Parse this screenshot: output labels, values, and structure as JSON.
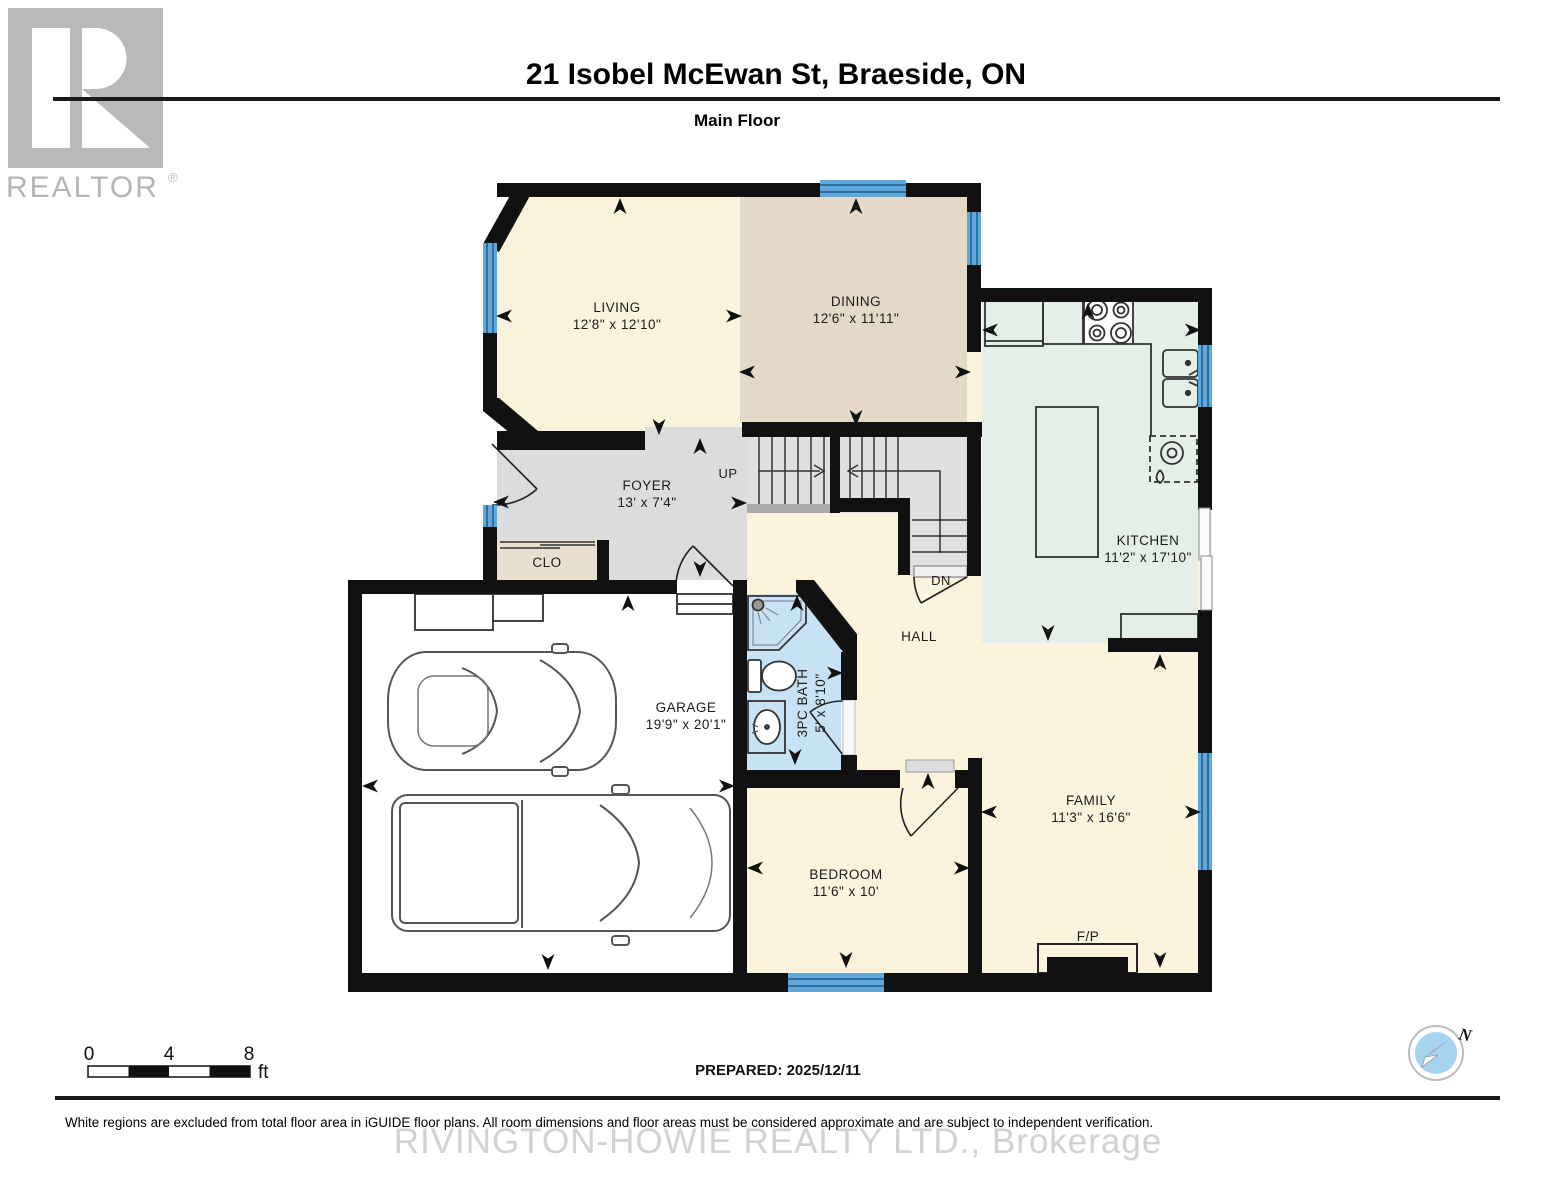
{
  "header": {
    "title": "21 Isobel McEwan St, Braeside, ON",
    "subtitle": "Main Floor",
    "logo": {
      "brand": "REALTOR",
      "registered": "®"
    }
  },
  "rooms": {
    "living": {
      "name": "LIVING",
      "dims": "12'8\" x 12'10\""
    },
    "dining": {
      "name": "DINING",
      "dims": "12'6\" x 11'11\""
    },
    "kitchen": {
      "name": "KITCHEN",
      "dims": "11'2\" x 17'10\""
    },
    "foyer": {
      "name": "FOYER",
      "dims": "13' x 7'4\""
    },
    "garage": {
      "name": "GARAGE",
      "dims": "19'9\" x 20'1\""
    },
    "bath": {
      "name": "3PC BATH",
      "dims": "5' x 8'10\""
    },
    "bedroom": {
      "name": "BEDROOM",
      "dims": "11'6\" x 10'"
    },
    "family": {
      "name": "FAMILY",
      "dims": "11'3\" x 16'6\""
    },
    "hall": {
      "name": "HALL"
    },
    "closet": {
      "name": "CLO"
    },
    "fireplace": {
      "name": "F/P"
    }
  },
  "stairs": {
    "up_label": "UP",
    "down_label": "DN"
  },
  "scale_bar": {
    "tick0": "0",
    "tick4": "4",
    "tick8": "8",
    "unit": "ft"
  },
  "prepared_label": "PREPARED: 2025/12/11",
  "compass": {
    "north_label": "N"
  },
  "footer": {
    "disclaimer": "White regions are excluded from total floor area in iGUIDE floor plans. All room dimensions and floor areas must be considered approximate and are subject to independent verification.",
    "watermark": "RIVINGTON-HOWIE REALTY LTD., Brokerage"
  },
  "colors": {
    "wall": "#111111",
    "window": "#5fa8dc",
    "window_stripe": "#2e6f9e",
    "living_fill": "#faf3dc",
    "dining_fill": "#e3d9c6",
    "kitchen_fill": "#e4efe8",
    "hall_fill": "#fbf3dc",
    "foyer_fill": "#dcdcdc",
    "bath_fill": "#c7e2f4",
    "closet_fill": "#e9dfce",
    "stairs_fill": "#e0e0e0"
  }
}
